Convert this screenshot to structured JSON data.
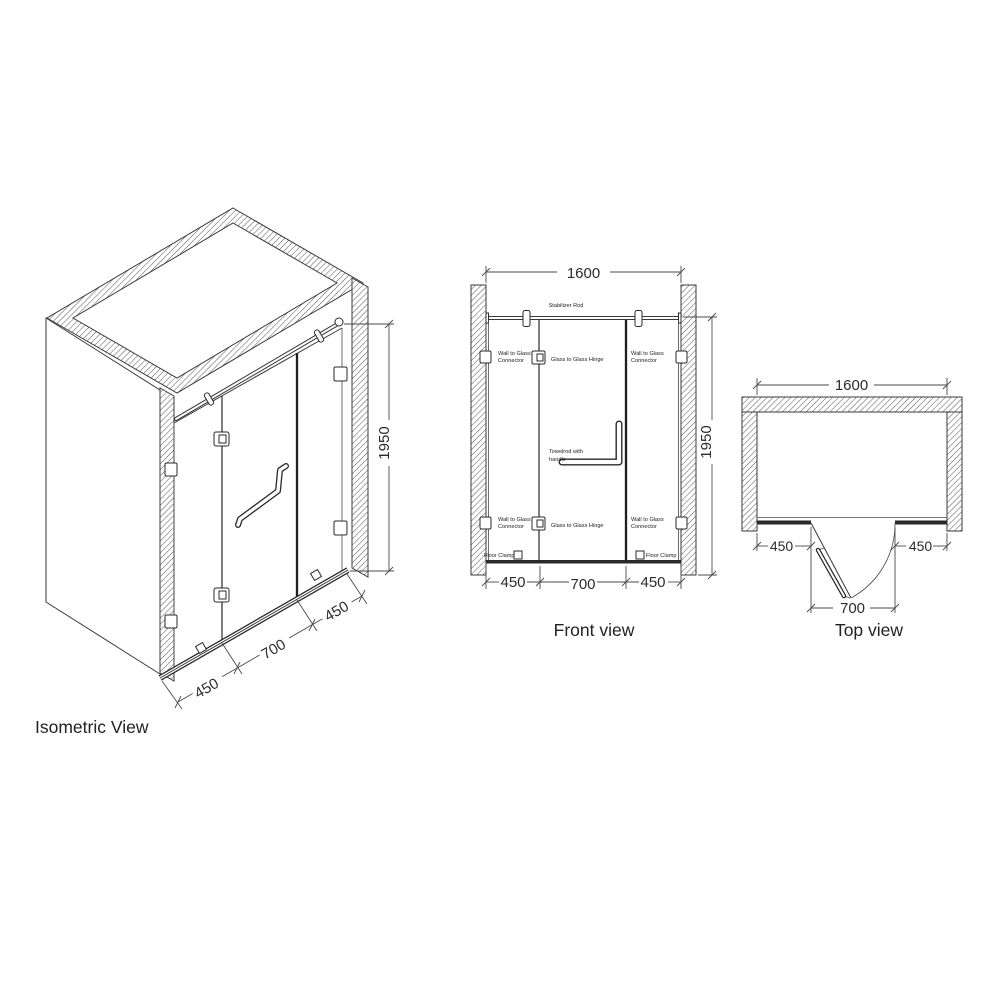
{
  "colors": {
    "background": "#ffffff",
    "line": "#3a3a3a",
    "text": "#222222"
  },
  "isometric": {
    "title": "Isometric View",
    "dim_height": "1950",
    "dim_left": "450",
    "dim_center": "700",
    "dim_right": "450"
  },
  "front": {
    "title": "Front view",
    "dim_width": "1600",
    "dim_height": "1950",
    "dim_left": "450",
    "dim_center": "700",
    "dim_right": "450",
    "labels": {
      "stabilizer_rod": "Stabilizer Rod",
      "wall_to_glass_line1": "Wall to Glass",
      "wall_to_glass_line2": "Connector",
      "glass_to_glass_hinge": "Glass to Glass Hinge",
      "towel_line1": "Towelrod with",
      "towel_line2": "handle",
      "floor_clamp": "Floor Clamp"
    }
  },
  "top": {
    "title": "Top view",
    "dim_width": "1600",
    "dim_left": "450",
    "dim_center": "700",
    "dim_right": "450"
  }
}
